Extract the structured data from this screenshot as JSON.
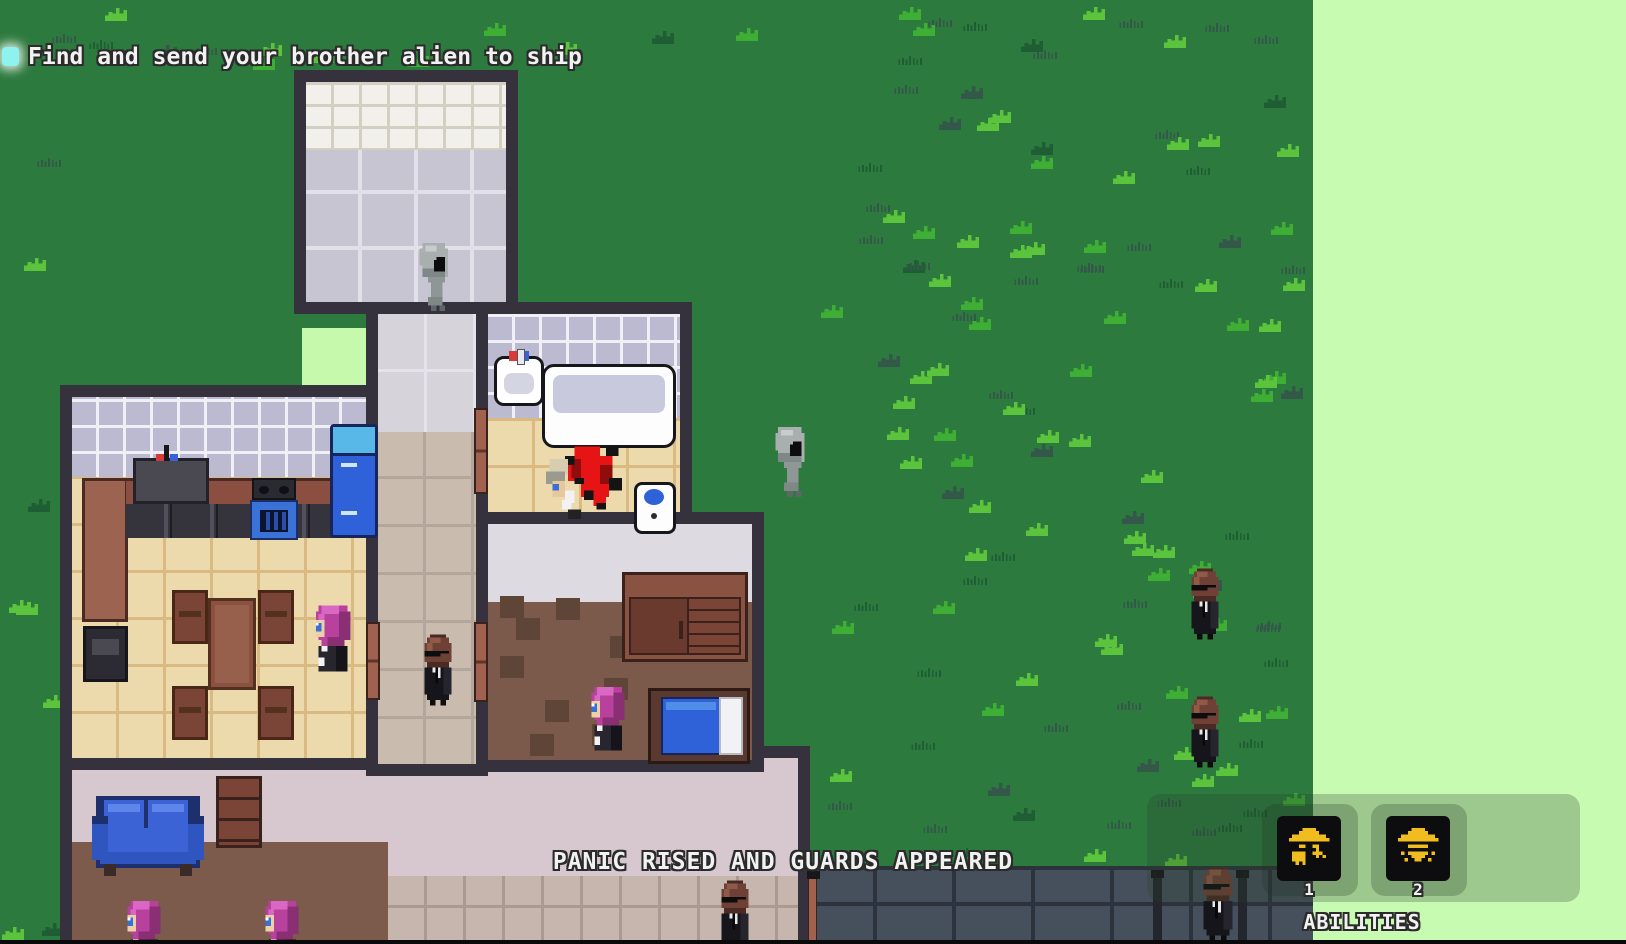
{
  "quest_tracker": {
    "marker_icon": "objective-checkbox-icon",
    "objective": "Find and send your brother alien to ship"
  },
  "event_banner": {
    "text": "PANIC RISED AND GUARDS APPEARED"
  },
  "abilities_bar": {
    "title": "ABILITIES",
    "slots": [
      {
        "hotkey": "1",
        "icon": "ufo-abduct-icon"
      },
      {
        "hotkey": "2",
        "icon": "ufo-beam-icon"
      }
    ]
  },
  "theme": {
    "objective_accent": "#8ef2ee",
    "ability_icon_gold": "#f0bc1e",
    "ability_slot_bg": "#0d0d10",
    "offscreen_overlay": "#c8fbb2",
    "grass_base": "#2d7a3e",
    "text_color": "#f2f2f2",
    "text_outline": "#2b2b2b"
  }
}
